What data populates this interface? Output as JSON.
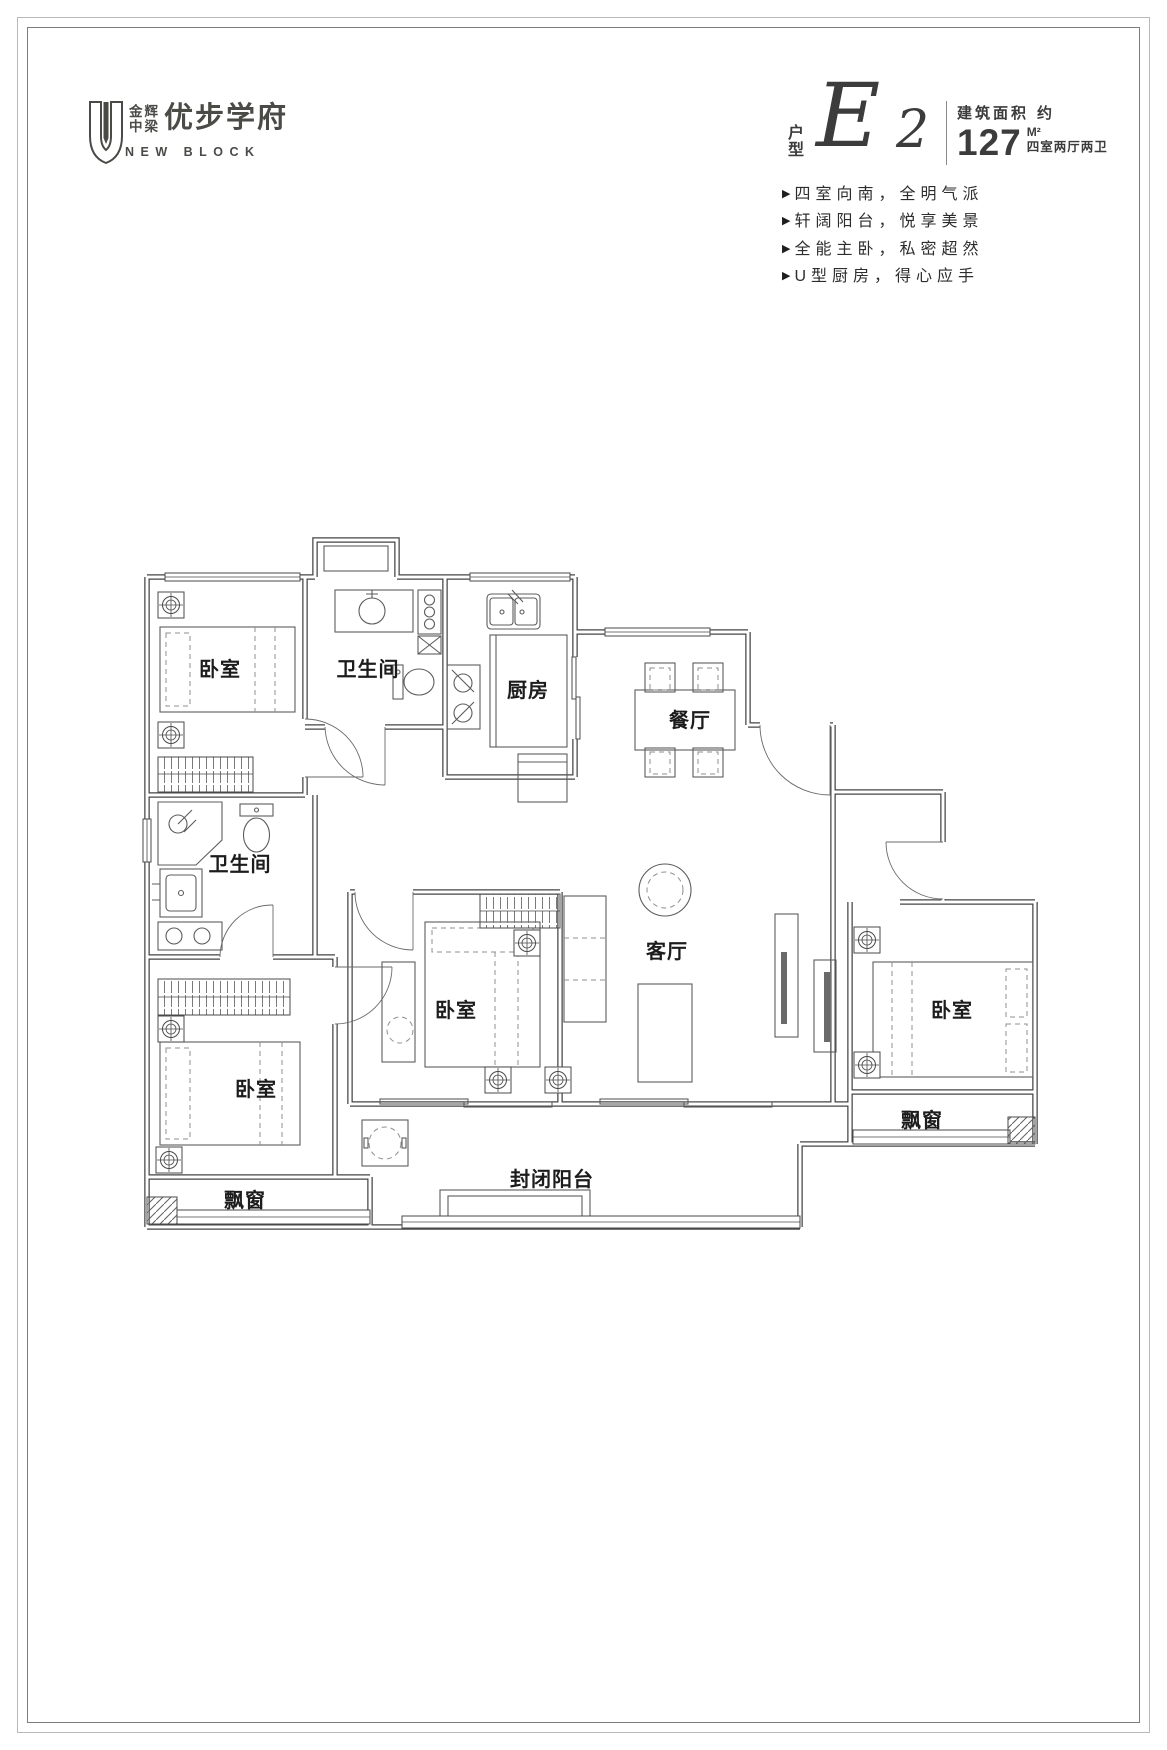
{
  "logo": {
    "brand_top": "金辉",
    "brand_bottom": "中梁",
    "name": "优步学府",
    "subtitle": "NEW BLOCK"
  },
  "header": {
    "unit_prefix_top": "户",
    "unit_prefix_bottom": "型",
    "unit_letter": "E",
    "unit_number": "2",
    "area_label": "建筑面积",
    "area_approx": "约",
    "area_value": "127",
    "area_unit": "M²",
    "layout_desc": "四室两厅两卫"
  },
  "features": {
    "marker": "▶",
    "items": [
      "四室向南，全明气派",
      "轩阔阳台，悦享美景",
      "全能主卧，私密超然",
      "U型厨房，得心应手"
    ]
  },
  "floor_plan": {
    "rooms": {
      "bedroom_top_left": "卧室",
      "bathroom_top": "卫生间",
      "kitchen": "厨房",
      "dining": "餐厅",
      "bathroom_left": "卫生间",
      "bedroom_middle": "卧室",
      "living": "客厅",
      "bedroom_right": "卧室",
      "bedroom_bottom_left": "卧室",
      "bay_window_left": "飘窗",
      "bay_window_right": "飘窗",
      "balcony": "封闭阳台"
    }
  },
  "colors": {
    "brand": "#4a4a46",
    "line": "#454545"
  }
}
